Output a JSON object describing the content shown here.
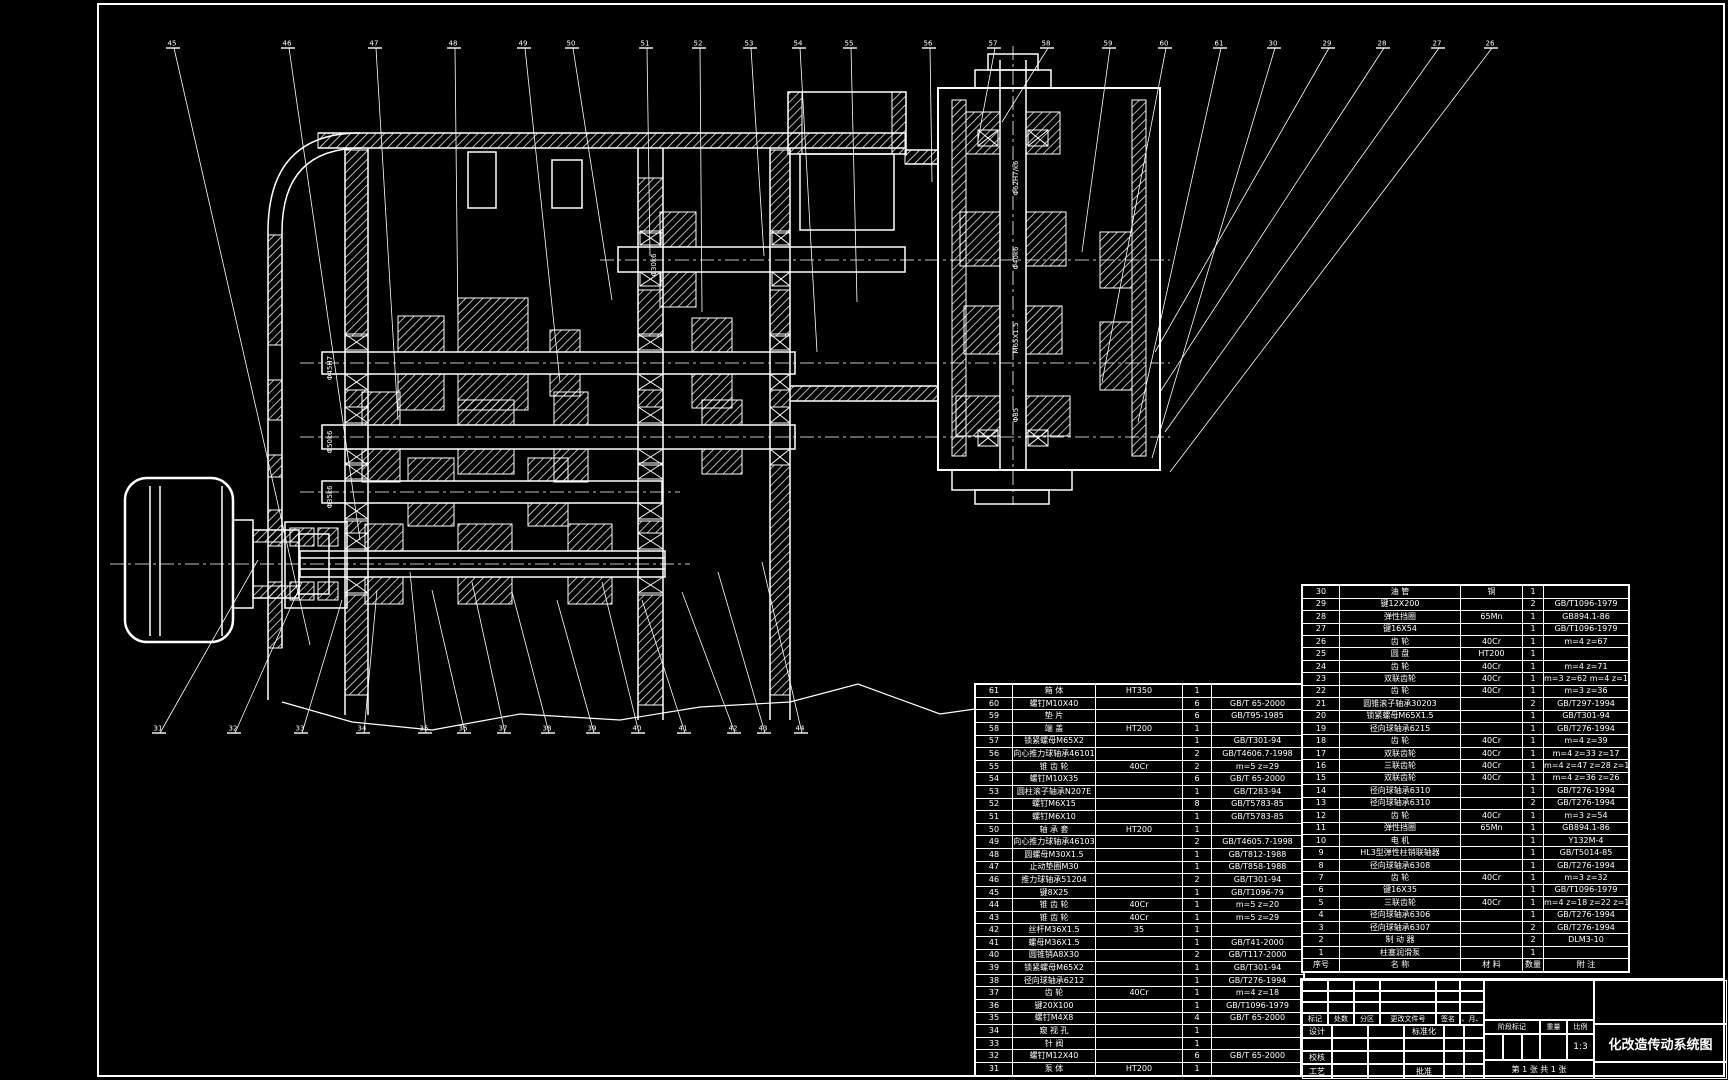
{
  "sheet": {
    "background": "#000000",
    "line_color": "#ffffff"
  },
  "title_block": {
    "title": "化改造传动系统图",
    "rev_headers": [
      "标记",
      "处数",
      "分区",
      "更改文件号",
      "签名",
      "年、月、日"
    ],
    "roles": {
      "design": "设计",
      "check": "校核",
      "process": "工艺",
      "standard": "标准化",
      "approve": "批准"
    },
    "stage_label": "阶段标记",
    "weight_label": "重量",
    "scale_label": "比例",
    "scale_value": "1:3",
    "sheet_info": "第 1 张  共 1 张"
  },
  "bom_right": {
    "headers": [
      "序号",
      "名  称",
      "材  料",
      "数量",
      "附  注"
    ],
    "rows": [
      [
        "30",
        "油 管",
        "铜",
        "1",
        ""
      ],
      [
        "29",
        "键12X200",
        "",
        "2",
        "GB/T1096-1979"
      ],
      [
        "28",
        "弹性挡圈",
        "65Mn",
        "1",
        "GB894.1-86"
      ],
      [
        "27",
        "键16X54",
        "",
        "1",
        "GB/T1096-1979"
      ],
      [
        "26",
        "齿 轮",
        "40Cr",
        "1",
        "m=4  z=67"
      ],
      [
        "25",
        "圆 盘",
        "HT200",
        "1",
        ""
      ],
      [
        "24",
        "齿 轮",
        "40Cr",
        "1",
        "m=4  z=71"
      ],
      [
        "23",
        "双联齿轮",
        "40Cr",
        "1",
        "m=3 z=62  m=4 z=19"
      ],
      [
        "22",
        "齿 轮",
        "40Cr",
        "1",
        "m=3  z=36"
      ],
      [
        "21",
        "圆锥滚子轴承30203",
        "",
        "2",
        "GB/T297-1994"
      ],
      [
        "20",
        "锁紧螺母M65X1.5",
        "",
        "1",
        "GB/T301-94"
      ],
      [
        "19",
        "径向球轴承6215",
        "",
        "1",
        "GB/T276-1994"
      ],
      [
        "18",
        "齿 轮",
        "40Cr",
        "1",
        "m=4  z=39"
      ],
      [
        "17",
        "双联齿轮",
        "40Cr",
        "1",
        "m=4 z=33  z=17"
      ],
      [
        "16",
        "三联齿轮",
        "40Cr",
        "1",
        "m=4 z=47  z=28  z=18"
      ],
      [
        "15",
        "双联齿轮",
        "40Cr",
        "1",
        "m=4 z=36  z=26"
      ],
      [
        "14",
        "径向球轴承6310",
        "",
        "1",
        "GB/T276-1994"
      ],
      [
        "13",
        "径向球轴承6310",
        "",
        "2",
        "GB/T276-1994"
      ],
      [
        "12",
        "齿 轮",
        "40Cr",
        "1",
        "m=3  z=54"
      ],
      [
        "11",
        "弹性挡圈",
        "65Mn",
        "1",
        "GB894.1-86"
      ],
      [
        "10",
        "电 机",
        "",
        "1",
        "Y132M-4"
      ],
      [
        "9",
        "HL3型弹性柱销联轴器",
        "",
        "1",
        "GB/T5014-85"
      ],
      [
        "8",
        "径向球轴承6308",
        "",
        "1",
        "GB/T276-1994"
      ],
      [
        "7",
        "齿 轮",
        "40Cr",
        "1",
        "m=3  z=32"
      ],
      [
        "6",
        "键16X35",
        "",
        "1",
        "GB/T1096-1979"
      ],
      [
        "5",
        "三联齿轮",
        "40Cr",
        "1",
        "m=4 z=18  z=22  z=19"
      ],
      [
        "4",
        "径向球轴承6306",
        "",
        "1",
        "GB/T276-1994"
      ],
      [
        "3",
        "径向球轴承6307",
        "",
        "2",
        "GB/T276-1994"
      ],
      [
        "2",
        "制 动 器",
        "",
        "2",
        "DLM3-10"
      ],
      [
        "1",
        "柱塞润滑泵",
        "",
        "1",
        ""
      ]
    ]
  },
  "bom_left": {
    "rows": [
      [
        "61",
        "箱 体",
        "HT350",
        "1",
        ""
      ],
      [
        "60",
        "螺钉M10X40",
        "",
        "6",
        "GB/T 65-2000"
      ],
      [
        "59",
        "垫 片",
        "",
        "6",
        "GB/T95-1985"
      ],
      [
        "58",
        "端 盖",
        "HT200",
        "1",
        ""
      ],
      [
        "57",
        "锁紧螺母M65X2",
        "",
        "1",
        "GB/T301-94"
      ],
      [
        "56",
        "向心推力球轴承46101",
        "",
        "2",
        "GB/T4606.7-1998"
      ],
      [
        "55",
        "锥 齿 轮",
        "40Cr",
        "2",
        "m=5  z=29"
      ],
      [
        "54",
        "螺钉M10X35",
        "",
        "6",
        "GB/T 65-2000"
      ],
      [
        "53",
        "圆柱滚子轴承N207E",
        "",
        "1",
        "GB/T283-94"
      ],
      [
        "52",
        "螺钉M6X15",
        "",
        "8",
        "GB/T5783-85"
      ],
      [
        "51",
        "螺钉M6X10",
        "",
        "1",
        "GB/T5783-85"
      ],
      [
        "50",
        "轴 承 套",
        "HT200",
        "1",
        ""
      ],
      [
        "49",
        "向心推力球轴承46103",
        "",
        "2",
        "GB/T4605.7-1998"
      ],
      [
        "48",
        "圆螺母M30X1.5",
        "",
        "1",
        "GB/T812-1988"
      ],
      [
        "47",
        "止动垫圈M30",
        "",
        "1",
        "GB/T858-1988"
      ],
      [
        "46",
        "推力球轴承51204",
        "",
        "2",
        "GB/T301-94"
      ],
      [
        "45",
        "键8X25",
        "",
        "1",
        "GB/T1096-79"
      ],
      [
        "44",
        "锥 齿 轮",
        "40Cr",
        "1",
        "m=5  z=20"
      ],
      [
        "43",
        "锥 齿 轮",
        "40Cr",
        "1",
        "m=5  z=29"
      ],
      [
        "42",
        "丝杆M36X1.5",
        "35",
        "1",
        ""
      ],
      [
        "41",
        "螺母M36X1.5",
        "",
        "1",
        "GB/T41-2000"
      ],
      [
        "40",
        "圆锥销A8X30",
        "",
        "2",
        "GB/T117-2000"
      ],
      [
        "39",
        "锁紧螺母M65X2",
        "",
        "1",
        "GB/T301-94"
      ],
      [
        "38",
        "径向球轴承6212",
        "",
        "1",
        "GB/T276-1994"
      ],
      [
        "37",
        "齿 轮",
        "40Cr",
        "1",
        "m=4  z=18"
      ],
      [
        "36",
        "键20X100",
        "",
        "1",
        "GB/T1096-1979"
      ],
      [
        "35",
        "螺钉M4X8",
        "",
        "4",
        "GB/T 65-2000"
      ],
      [
        "34",
        "窥 视 孔",
        "",
        "1",
        ""
      ],
      [
        "33",
        "针 阀",
        "",
        "1",
        ""
      ],
      [
        "32",
        "螺钉M12X40",
        "",
        "6",
        "GB/T 65-2000"
      ],
      [
        "31",
        "泵 体",
        "HT200",
        "1",
        ""
      ]
    ]
  },
  "callouts": {
    "top": [
      "45",
      "46",
      "47",
      "48",
      "49",
      "50",
      "51",
      "52",
      "53",
      "54",
      "55",
      "56",
      "57",
      "58",
      "59",
      "60",
      "61",
      "30",
      "29",
      "28",
      "27",
      "26"
    ],
    "bottom": [
      "31",
      "32",
      "33",
      "34",
      "35",
      "36",
      "37",
      "38",
      "39",
      "40",
      "41",
      "42",
      "43",
      "44"
    ]
  },
  "dims": [
    {
      "text": "Φ62H7/k6",
      "x": 1018,
      "y": 178,
      "rot": -90
    },
    {
      "text": "Φ40k6",
      "x": 1018,
      "y": 258,
      "rot": -90
    },
    {
      "text": "M65X1.5",
      "x": 1018,
      "y": 338,
      "rot": -90
    },
    {
      "text": "Φ85",
      "x": 1018,
      "y": 415,
      "rot": -90
    },
    {
      "text": "Φ30k6",
      "x": 656,
      "y": 265,
      "rot": -90
    },
    {
      "text": "Φ45H7",
      "x": 332,
      "y": 368,
      "rot": -90
    },
    {
      "text": "Φ50k6",
      "x": 332,
      "y": 442,
      "rot": -90
    },
    {
      "text": "Φ35k6",
      "x": 332,
      "y": 497,
      "rot": -90
    }
  ]
}
